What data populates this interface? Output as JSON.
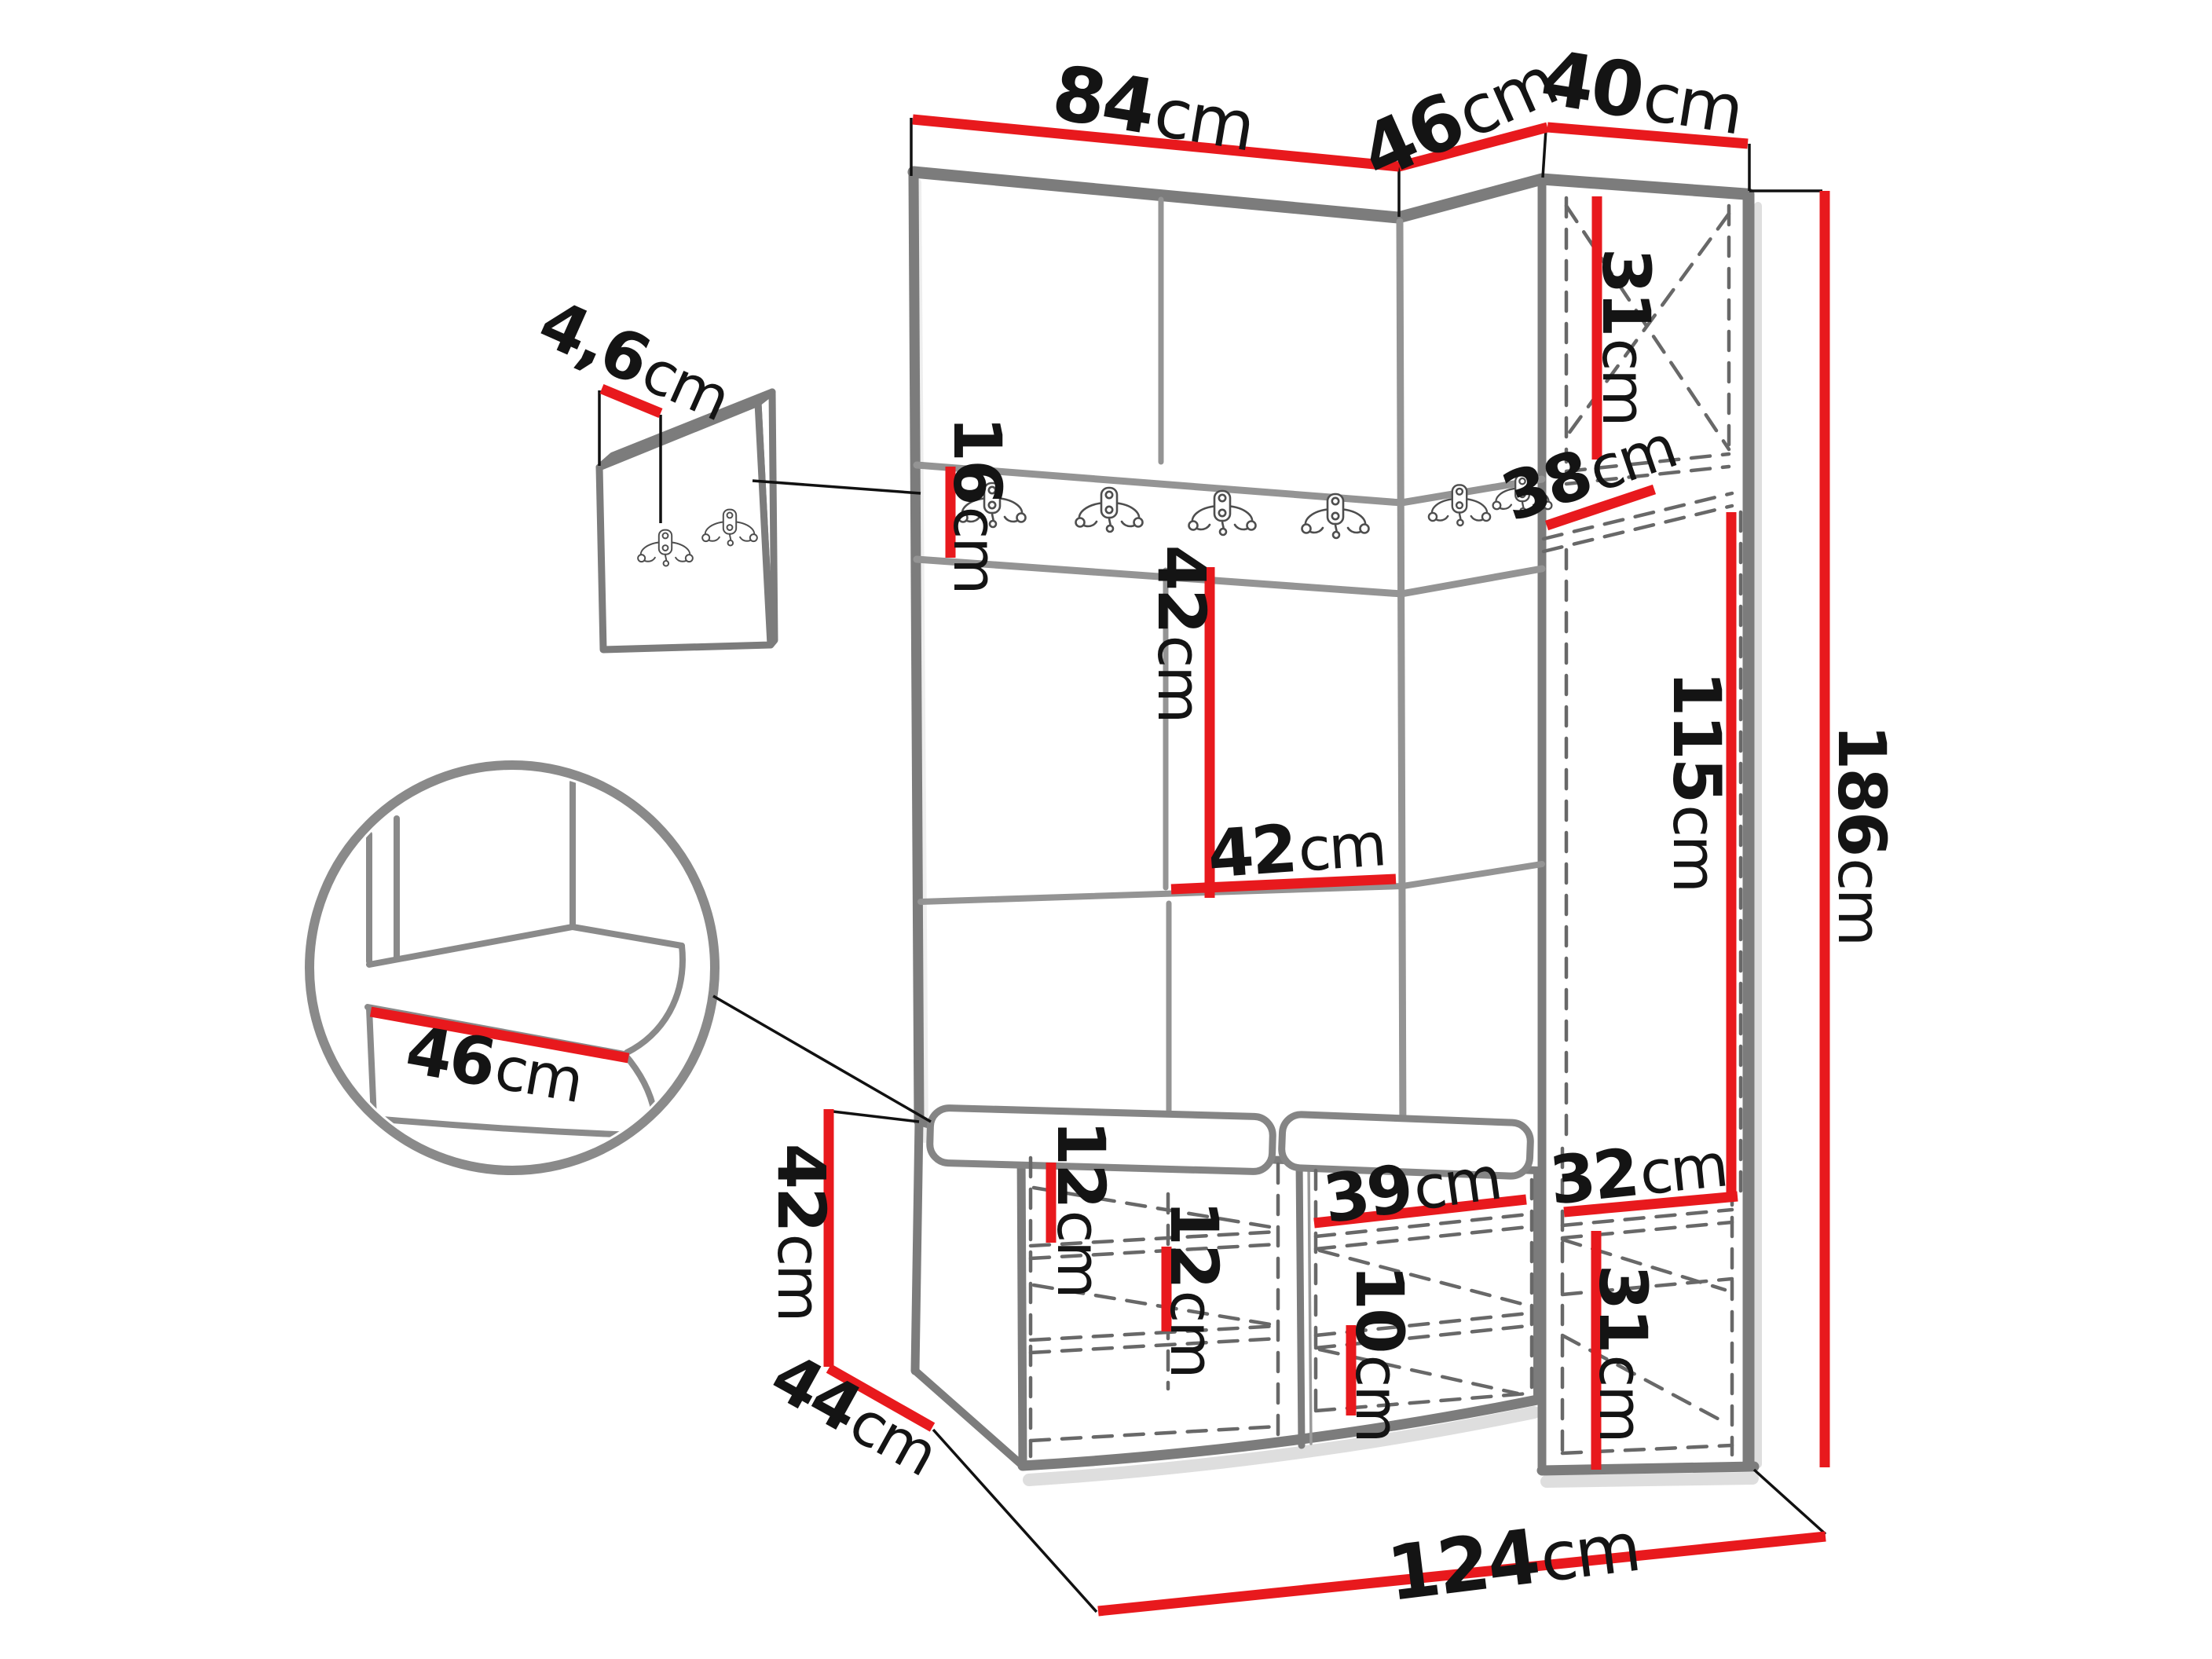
{
  "figure": {
    "type": "furniture-dimension-diagram",
    "subject": "hallway wardrobe set with padded wall panels, hook rail, tall cabinet and shoe bench",
    "unit_system": "cm"
  },
  "colors": {
    "dimension_line": "#e8191d",
    "outline_gray": "#7c7c7c",
    "hidden_edge_dash": "#686868",
    "label_text": "#141414",
    "background": "#ffffff"
  },
  "labels": {
    "wall_width": {
      "value": "84",
      "unit": "cm"
    },
    "corner_width": {
      "value": "46",
      "unit": "cm"
    },
    "cabinet_width": {
      "value": "40",
      "unit": "cm"
    },
    "hook_panel_thickness": {
      "value": "4,6",
      "unit": "cm"
    },
    "hook_rail_height": {
      "value": "16",
      "unit": "cm"
    },
    "cabinet_top_height": {
      "value": "31",
      "unit": "cm"
    },
    "cabinet_depth": {
      "value": "38",
      "unit": "cm"
    },
    "wall_panel_height": {
      "value": "42",
      "unit": "cm"
    },
    "wall_panel_width": {
      "value": "42",
      "unit": "cm"
    },
    "cabinet_door_height": {
      "value": "115",
      "unit": "cm"
    },
    "total_height": {
      "value": "186",
      "unit": "cm"
    },
    "seat_width_detail": {
      "value": "46",
      "unit": "cm"
    },
    "bench_height": {
      "value": "42",
      "unit": "cm"
    },
    "bench_depth": {
      "value": "44",
      "unit": "cm"
    },
    "bench_shelf_gap_upper": {
      "value": "12",
      "unit": "cm"
    },
    "bench_shelf_gap_lower": {
      "value": "12",
      "unit": "cm"
    },
    "bench_right_width": {
      "value": "39",
      "unit": "cm"
    },
    "bench_right_shelf_gap": {
      "value": "10",
      "unit": "cm"
    },
    "bottom_shelf_depth": {
      "value": "32",
      "unit": "cm"
    },
    "bottom_door_height": {
      "value": "31",
      "unit": "cm"
    },
    "total_width": {
      "value": "124",
      "unit": "cm"
    }
  }
}
